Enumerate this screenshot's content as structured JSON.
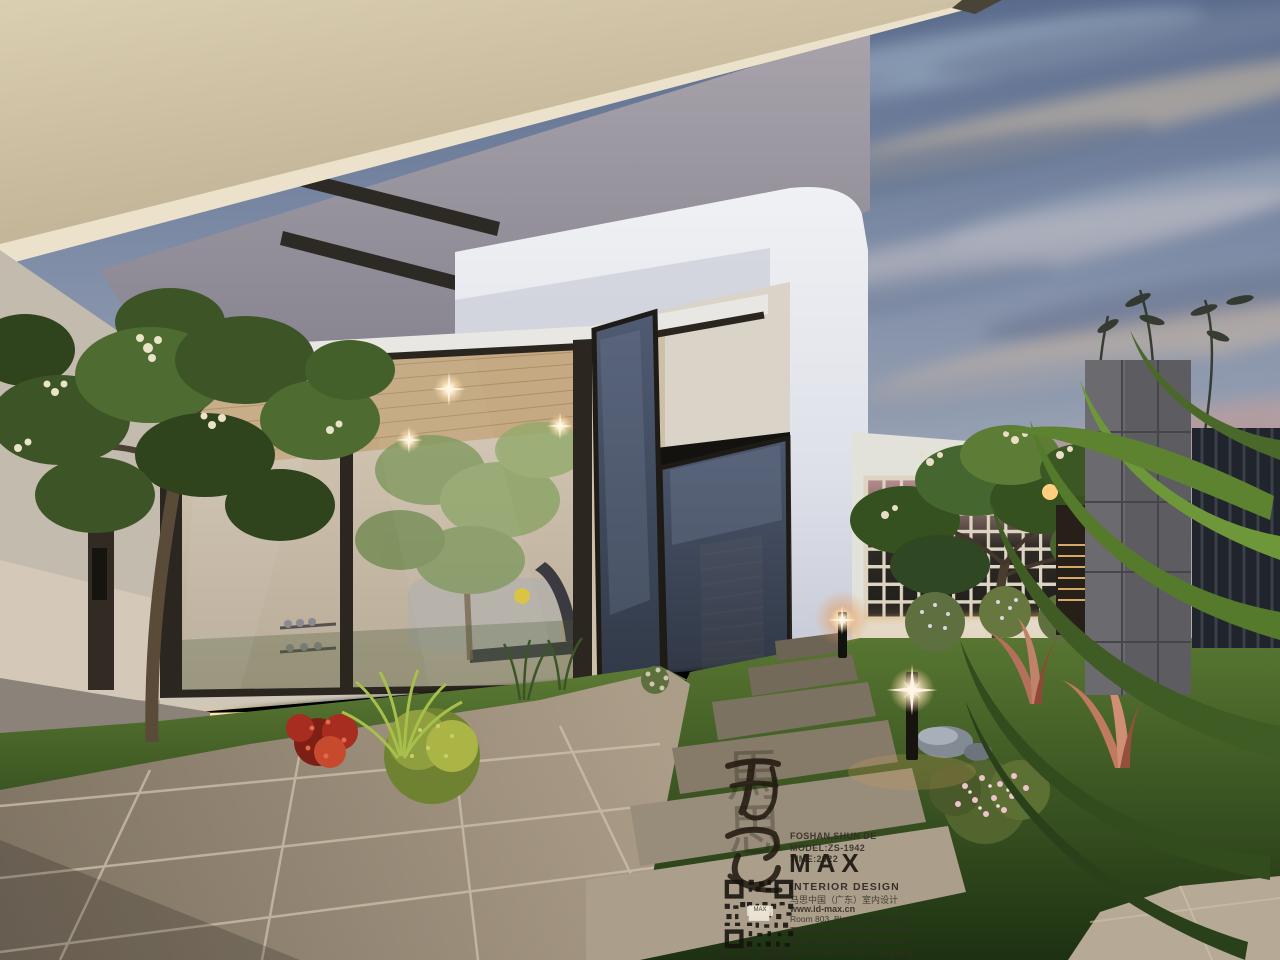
{
  "scene": {
    "description": "Dusk 3D architectural rendering of a modern villa courtyard: a dark-framed glass sunroom gym with open folding doors, frangipani trees, landscaped garden beds, breeze-block screen wall, stone path with bollard lights, large stone-tile terrace and a dramatic cloudy evening sky",
    "labels": {
      "sky": "evening sky with streaked clouds",
      "eave": "cream roof eave soffit",
      "sunroom": "glass sunroom gym",
      "doors": "open folding glass doors",
      "breeze_wall": "breeze-block screen wall",
      "path": "stone slab garden path",
      "terrace": "stone tile terrace",
      "bollards": "garden bollard lights"
    }
  },
  "watermark": {
    "calligraphy": "馬\n思",
    "location_line": "FOSHAN,SHUN DE",
    "model_line": "MODEL:ZS-1942",
    "time_line": "TIME:2022",
    "logo": "MAX",
    "subtitle": "INTERIOR DESIGN",
    "company_cn": "马思中国（广东）室内设计",
    "website": "www.id-max.cn",
    "address": {
      "0": "Room 803, Block A, Building 5,",
      "1": "Tianan Cyber Park, No.1 Jianping",
      "2": "Road, Guicheng Street, Nanhai",
      "3": "District,Foshan City, Guangdong",
      "4": "Province, China"
    },
    "qr_center_label": "MAX",
    "qr_caption": "扫一扫，了解更多"
  },
  "palette": {
    "sky_top": "#5a6b8c",
    "sky_mid": "#8e99ae",
    "sky_warm": "#dcc3a2",
    "sky_pink": "#c39a9b",
    "eave_cream": "#d6c9aa",
    "concrete_grey": "#9b97a0",
    "house_white": "#e9ebf0",
    "frame_bronze": "#2b2620",
    "interior_warm": "#ddd0ba",
    "led_glow": "#f6c36a",
    "grass": "#55752f",
    "tile_beige": "#a59882",
    "flower_red": "#b03524",
    "flower_pink": "#eec3cd"
  }
}
